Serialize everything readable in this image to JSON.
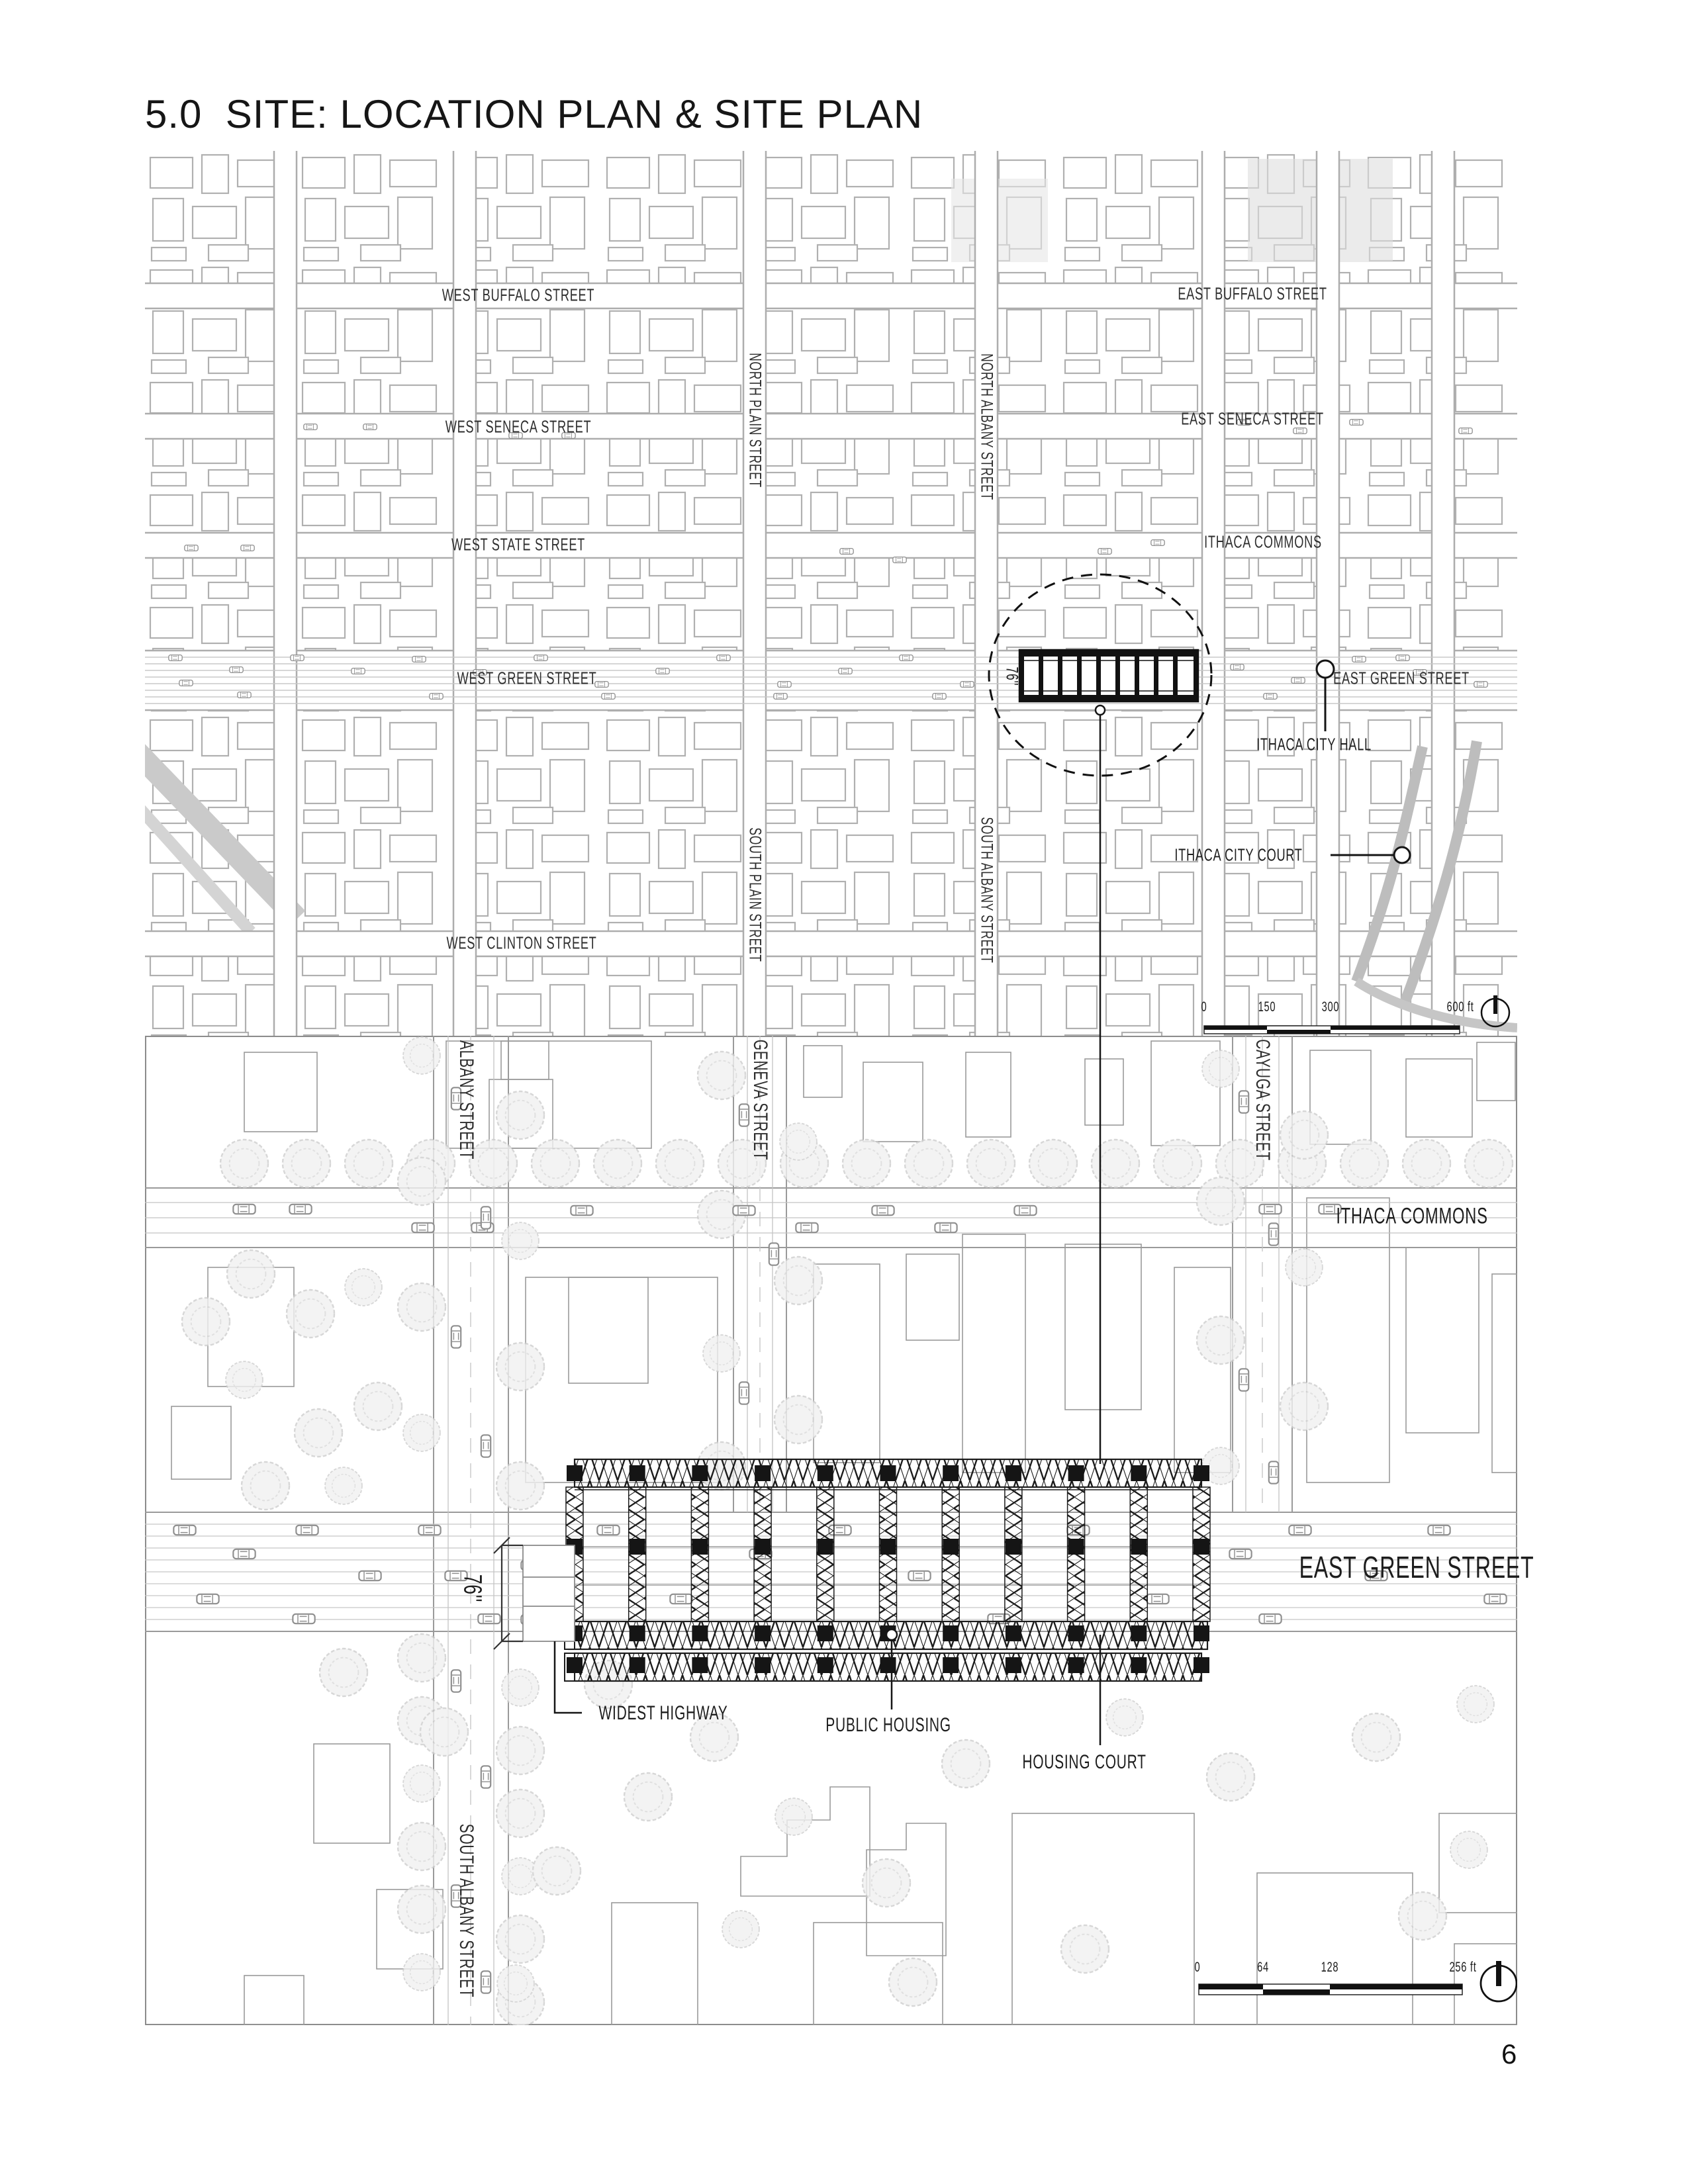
{
  "title": "5.0  SITE: LOCATION PLAN & SITE PLAN",
  "page_number": "6",
  "location_plan": {
    "streets": {
      "west_buffalo": "WEST BUFFALO STREET",
      "east_buffalo": "EAST BUFFALO STREET",
      "west_seneca": "WEST SENECA STREET",
      "east_seneca": "EAST SENECA STREET",
      "west_state": "WEST STATE STREET",
      "ithaca_commons": "ITHACA COMMONS",
      "west_green": "WEST GREEN STREET",
      "east_green": "EAST GREEN STREET",
      "west_clinton": "WEST CLINTON STREET",
      "north_plain": "NORTH PLAIN STREET",
      "north_albany": "NORTH ALBANY STREET",
      "south_plain": "SOUTH PLAIN STREET",
      "south_albany": "SOUTH ALBANY STREET"
    },
    "landmarks": {
      "city_hall": "ITHACA CITY HALL",
      "city_court": "ITHACA CITY COURT"
    },
    "dimension_label": "76''",
    "scale_bar": {
      "ticks": [
        "0",
        "150",
        "300",
        "600 ft"
      ]
    }
  },
  "site_plan": {
    "streets": {
      "albany": "ALBANY STREET",
      "geneva": "GENEVA STREET",
      "cayuga": "CAYUGA STREET",
      "ithaca_commons": "ITHACA COMMONS",
      "east_green": "EAST GREEN STREET",
      "south_albany": "SOUTH ALBANY STREET"
    },
    "labels": {
      "widest_highway": "WIDEST HIGHWAY",
      "public_housing": "PUBLIC HOUSING",
      "housing_court": "HOUSING COURT"
    },
    "dimension_label": "76''",
    "scale_bar": {
      "ticks": [
        "0",
        "64",
        "128",
        "256 ft"
      ]
    }
  },
  "colors": {
    "ink": "#1a1a1a",
    "map_gray": "#b3b3b3",
    "light_gray": "#d9d9d9"
  }
}
